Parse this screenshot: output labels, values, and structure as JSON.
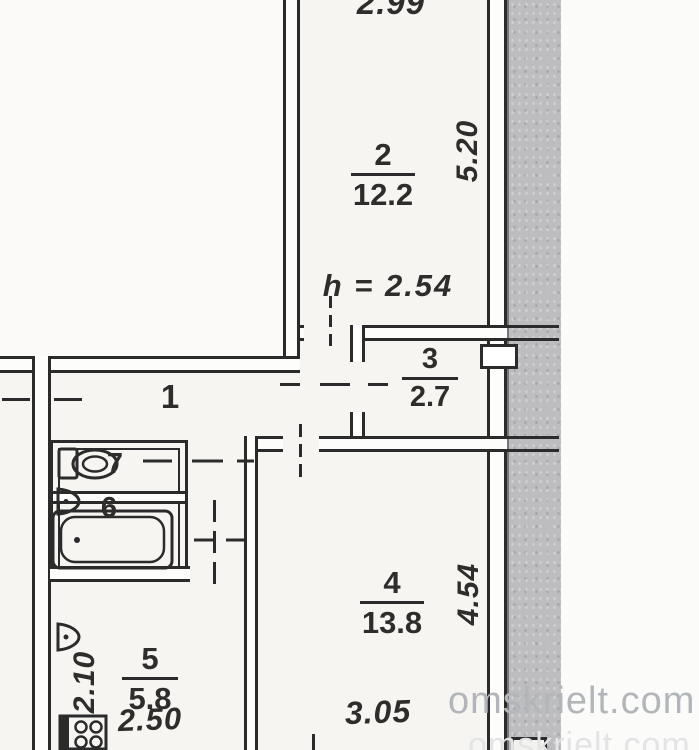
{
  "watermark": {
    "primary": "omskrielt.com",
    "secondary": "omskrielt.com"
  },
  "rooms": {
    "r1": {
      "number": "1"
    },
    "r2": {
      "number": "2",
      "area": "12.2"
    },
    "r3": {
      "number": "3",
      "area": "2.7"
    },
    "r4": {
      "number": "4",
      "area": "13.8"
    },
    "r5": {
      "number": "5",
      "area": "5.8"
    },
    "r6": {
      "number": "6"
    },
    "r7": {
      "number": "7"
    }
  },
  "dimensions": {
    "top_width": "2.99",
    "room2_depth": "5.20",
    "ceiling_height": "h = 2.54",
    "room4_depth": "4.54",
    "room4_width": "3.05",
    "kitchen_depth": "2.10",
    "kitchen_width": "2.50"
  },
  "icons": {
    "toilet": "toilet-icon",
    "bathtub": "bathtub-icon",
    "bath_sink": "sink-icon",
    "kitchen_sink": "sink-icon",
    "stove": "stove-icon"
  },
  "colors": {
    "line": "#2b2b2b",
    "paper": "#f6f5f2",
    "scan_band": "#bdbdbf",
    "watermark": "#b2b5b9"
  }
}
